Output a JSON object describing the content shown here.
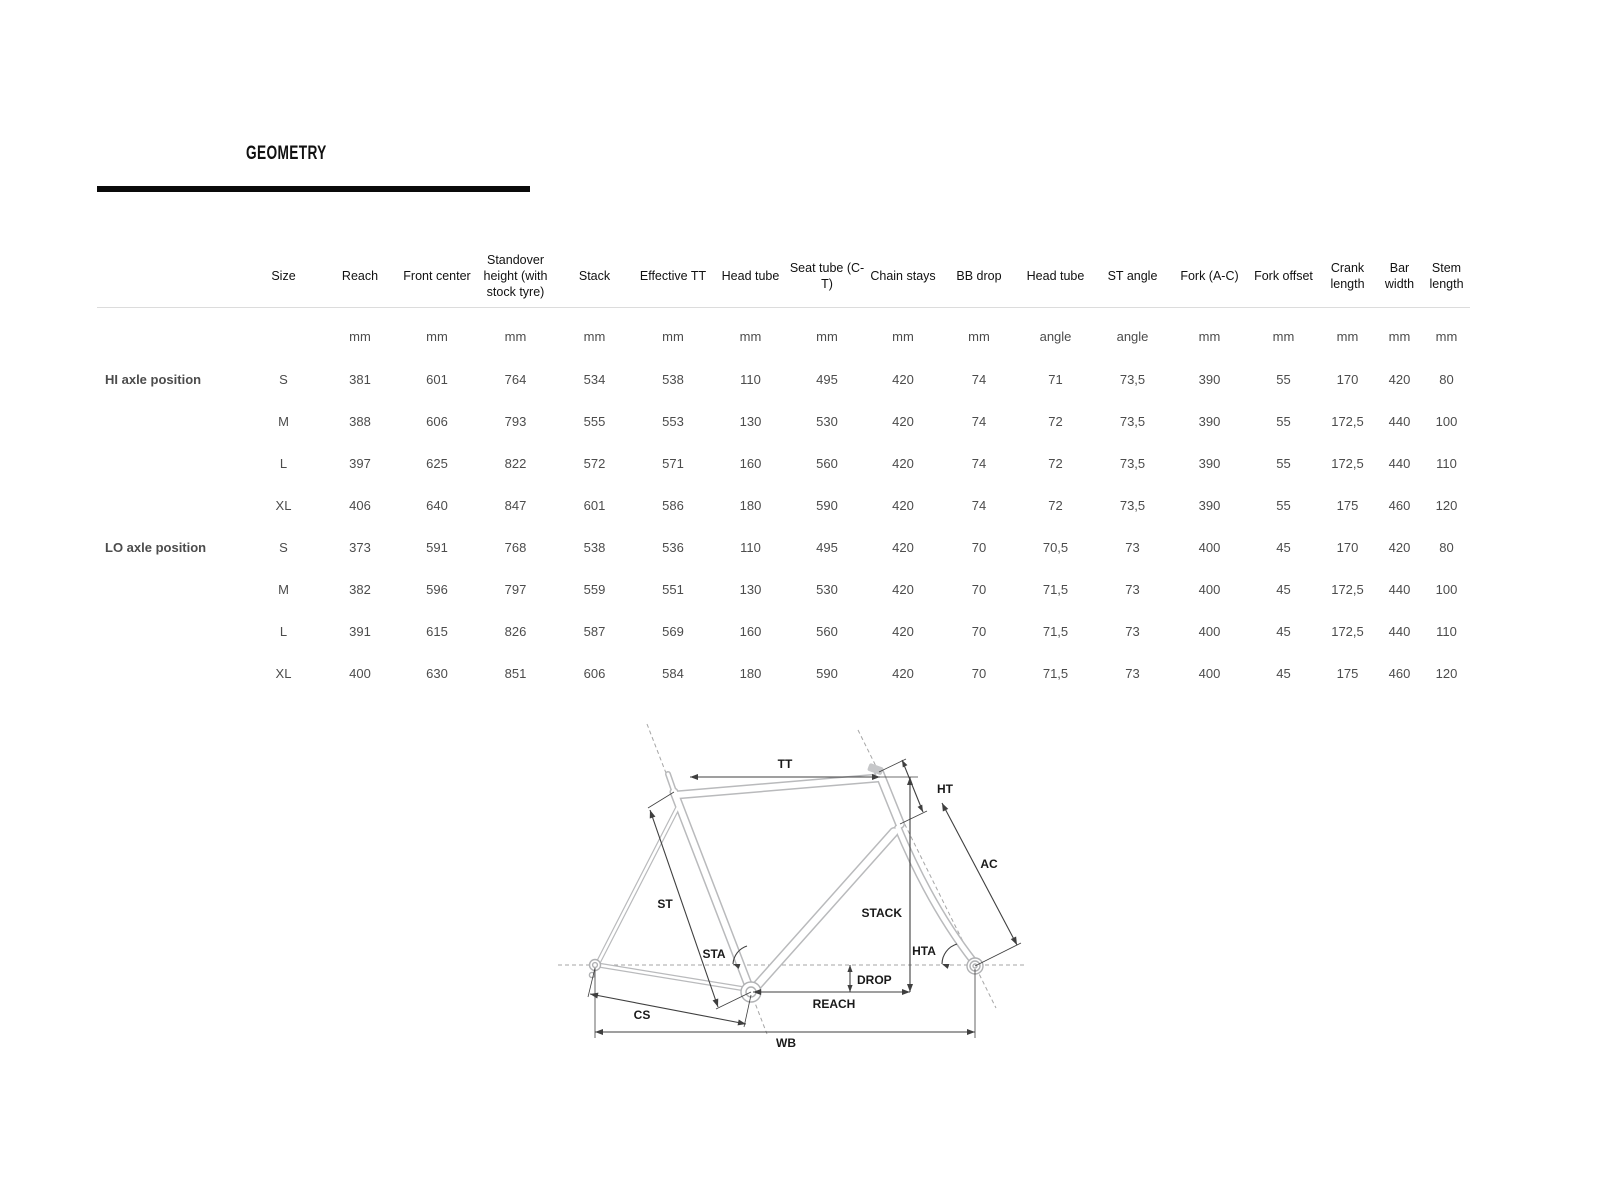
{
  "page": {
    "title": "GEOMETRY"
  },
  "chart_data": {
    "type": "table",
    "title": "GEOMETRY",
    "headers": [
      "Size",
      "Reach",
      "Front center",
      "Standover height (with stock tyre)",
      "Stack",
      "Effective TT",
      "Head tube",
      "Seat tube (C-T)",
      "Chain stays",
      "BB drop",
      "Head tube",
      "ST angle",
      "Fork (A-C)",
      "Fork offset",
      "Crank length",
      "Bar width",
      "Stem length"
    ],
    "units": [
      "",
      "mm",
      "mm",
      "mm",
      "mm",
      "mm",
      "mm",
      "mm",
      "mm",
      "mm",
      "angle",
      "angle",
      "mm",
      "mm",
      "mm",
      "mm",
      "mm"
    ],
    "row_groups": [
      {
        "label": "HI axle position",
        "rows": [
          {
            "cells": [
              "S",
              "381",
              "601",
              "764",
              "534",
              "538",
              "110",
              "495",
              "420",
              "74",
              "71",
              "73,5",
              "390",
              "55",
              "170",
              "420",
              "80"
            ]
          },
          {
            "cells": [
              "M",
              "388",
              "606",
              "793",
              "555",
              "553",
              "130",
              "530",
              "420",
              "74",
              "72",
              "73,5",
              "390",
              "55",
              "172,5",
              "440",
              "100"
            ]
          },
          {
            "cells": [
              "L",
              "397",
              "625",
              "822",
              "572",
              "571",
              "160",
              "560",
              "420",
              "74",
              "72",
              "73,5",
              "390",
              "55",
              "172,5",
              "440",
              "110"
            ]
          },
          {
            "cells": [
              "XL",
              "406",
              "640",
              "847",
              "601",
              "586",
              "180",
              "590",
              "420",
              "74",
              "72",
              "73,5",
              "390",
              "55",
              "175",
              "460",
              "120"
            ]
          }
        ]
      },
      {
        "label": "LO axle position",
        "rows": [
          {
            "cells": [
              "S",
              "373",
              "591",
              "768",
              "538",
              "536",
              "110",
              "495",
              "420",
              "70",
              "70,5",
              "73",
              "400",
              "45",
              "170",
              "420",
              "80"
            ]
          },
          {
            "cells": [
              "M",
              "382",
              "596",
              "797",
              "559",
              "551",
              "130",
              "530",
              "420",
              "70",
              "71,5",
              "73",
              "400",
              "45",
              "172,5",
              "440",
              "100"
            ]
          },
          {
            "cells": [
              "L",
              "391",
              "615",
              "826",
              "587",
              "569",
              "160",
              "560",
              "420",
              "70",
              "71,5",
              "73",
              "400",
              "45",
              "172,5",
              "440",
              "110"
            ]
          },
          {
            "cells": [
              "XL",
              "400",
              "630",
              "851",
              "606",
              "584",
              "180",
              "590",
              "420",
              "70",
              "71,5",
              "73",
              "400",
              "45",
              "175",
              "460",
              "120"
            ]
          }
        ]
      }
    ]
  },
  "diagram": {
    "labels": {
      "tt": "TT",
      "ht": "HT",
      "ac": "AC",
      "st": "ST",
      "sta": "STA",
      "stack": "STACK",
      "hta": "HTA",
      "drop": "DROP",
      "reach": "REACH",
      "cs": "CS",
      "wb": "WB"
    }
  },
  "colors": {
    "rule": "#0a0a0a",
    "frame_outline": "#b9babc",
    "dimension_line": "#3f3f3f",
    "axis_dash": "#a6a6a6",
    "separator": "#dcdcdc"
  }
}
